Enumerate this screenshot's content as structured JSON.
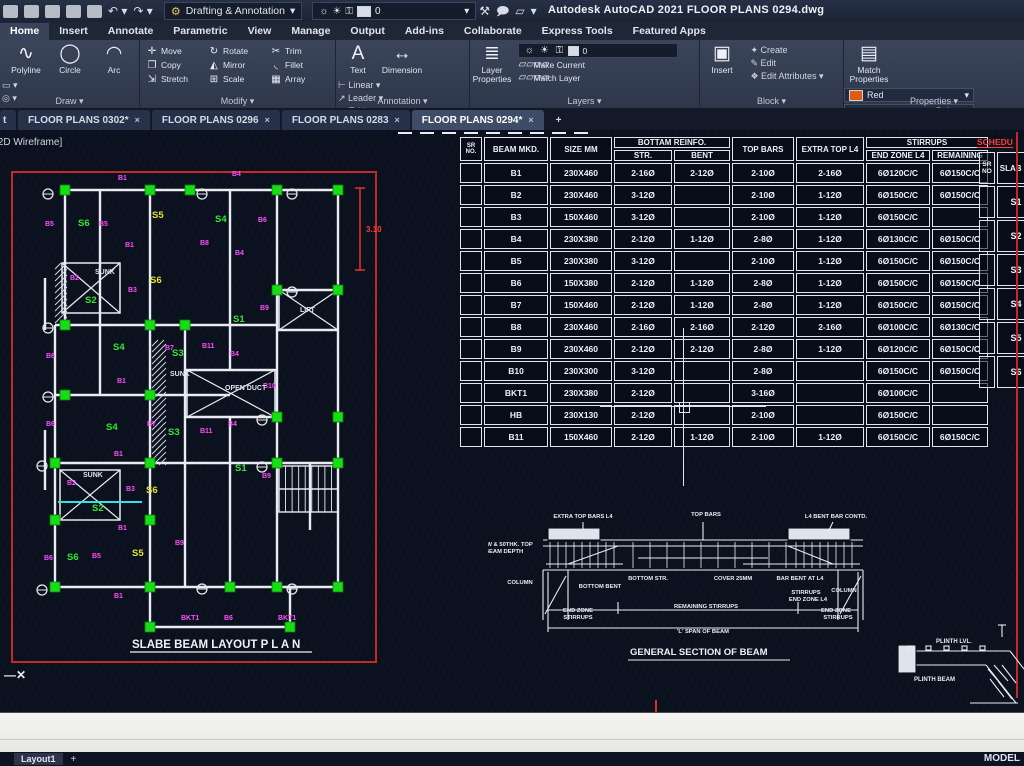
{
  "titlebar": {
    "workspace": "Drafting & Annotation",
    "app_title": "Autodesk AutoCAD 2021   FLOOR PLANS 0294.dwg",
    "layer_value": "0"
  },
  "ribbon": {
    "tabs": [
      {
        "label": "Home",
        "active": true
      },
      {
        "label": "Insert"
      },
      {
        "label": "Annotate"
      },
      {
        "label": "Parametric"
      },
      {
        "label": "View"
      },
      {
        "label": "Manage"
      },
      {
        "label": "Output"
      },
      {
        "label": "Add-ins"
      },
      {
        "label": "Collaborate"
      },
      {
        "label": "Express Tools"
      },
      {
        "label": "Featured Apps"
      }
    ],
    "draw": {
      "title": "Draw",
      "big": [
        "Polyline",
        "Circle",
        "Arc"
      ]
    },
    "modify": {
      "title": "Modify",
      "grid": [
        "Move",
        "Rotate",
        "Trim",
        "Copy",
        "Mirror",
        "Fillet",
        "Stretch",
        "Scale",
        "Array"
      ]
    },
    "annotation": {
      "title": "Annotation",
      "big": [
        "Text",
        "Dimension"
      ],
      "small": [
        "Linear",
        "Leader",
        "Table"
      ]
    },
    "layers": {
      "title": "Layers",
      "big": "Layer\nProperties",
      "layer_value": "0",
      "small": [
        "Make Current",
        "Match Layer"
      ]
    },
    "block": {
      "title": "Block",
      "big": "Insert",
      "small": [
        "Create",
        "Edit",
        "Edit Attributes"
      ]
    },
    "properties": {
      "title": "Properties",
      "big": "Match\nProperties",
      "color": "Red",
      "linetype": "ByLayer",
      "lineweight": "ByLayer"
    }
  },
  "file_tabs": {
    "partial": "t",
    "tabs": [
      {
        "label": "FLOOR PLANS 0302*",
        "active": false
      },
      {
        "label": "FLOOR PLANS 0296",
        "active": false
      },
      {
        "label": "FLOOR PLANS 0283",
        "active": false
      },
      {
        "label": "FLOOR PLANS 0294*",
        "active": true
      }
    ],
    "new_tab": "+"
  },
  "viewport_label": "[2D Wireframe]",
  "plan": {
    "title": "SLABE BEAM LAYOUT  P L A N",
    "dim_label": "3.10",
    "labels": [
      [
        "B1",
        118,
        50,
        "m"
      ],
      [
        "B1",
        125,
        117,
        "m"
      ],
      [
        "B1",
        117,
        253,
        "m"
      ],
      [
        "B1",
        114,
        326,
        "m"
      ],
      [
        "B1",
        118,
        400,
        "m"
      ],
      [
        "B1",
        114,
        468,
        "m"
      ],
      [
        "B2",
        70,
        150,
        "m"
      ],
      [
        "B2",
        67,
        355,
        "m"
      ],
      [
        "B3",
        128,
        162,
        "m"
      ],
      [
        "B3",
        126,
        361,
        "m"
      ],
      [
        "B4",
        232,
        46,
        "m"
      ],
      [
        "B4",
        235,
        125,
        "m"
      ],
      [
        "B4",
        230,
        226,
        "m"
      ],
      [
        "B4",
        228,
        296,
        "m"
      ],
      [
        "B5",
        45,
        96,
        "m"
      ],
      [
        "B5",
        99,
        96,
        "m"
      ],
      [
        "B5",
        92,
        428,
        "m"
      ],
      [
        "B6",
        258,
        92,
        "m"
      ],
      [
        "B6",
        46,
        228,
        "m"
      ],
      [
        "B6",
        46,
        296,
        "m"
      ],
      [
        "B6",
        44,
        430,
        "m"
      ],
      [
        "B6",
        224,
        490,
        "m"
      ],
      [
        "B7",
        165,
        220,
        "m"
      ],
      [
        "B7",
        147,
        296,
        "m"
      ],
      [
        "B8",
        200,
        115,
        "m"
      ],
      [
        "B9",
        260,
        180,
        "m"
      ],
      [
        "B9",
        262,
        348,
        "m"
      ],
      [
        "B9",
        175,
        415,
        "m"
      ],
      [
        "B10",
        263,
        258,
        "m"
      ],
      [
        "B11",
        202,
        218,
        "m"
      ],
      [
        "B11",
        200,
        303,
        "m"
      ],
      [
        "BKT1",
        181,
        490,
        "m"
      ],
      [
        "BKT1",
        278,
        490,
        "m"
      ],
      [
        "S1",
        233,
        192,
        "g"
      ],
      [
        "S1",
        235,
        341,
        "g"
      ],
      [
        "S2",
        85,
        173,
        "g"
      ],
      [
        "S2",
        92,
        381,
        "g"
      ],
      [
        "S3",
        172,
        226,
        "g"
      ],
      [
        "S3",
        168,
        305,
        "g"
      ],
      [
        "S4",
        215,
        92,
        "g"
      ],
      [
        "S4",
        113,
        220,
        "g"
      ],
      [
        "S4",
        106,
        300,
        "g"
      ],
      [
        "S5",
        152,
        88,
        "y"
      ],
      [
        "S5",
        132,
        426,
        "y"
      ],
      [
        "S6",
        78,
        96,
        "g"
      ],
      [
        "S6",
        67,
        430,
        "g"
      ],
      [
        "S6",
        150,
        153,
        "y"
      ],
      [
        "S6",
        146,
        363,
        "y"
      ],
      [
        "SUNK",
        95,
        144,
        "w"
      ],
      [
        "SUNK",
        170,
        246,
        "w"
      ],
      [
        "SUNK",
        83,
        347,
        "w"
      ],
      [
        "LIFT",
        300,
        182,
        "w"
      ],
      [
        "OPEN DUCT",
        225,
        260,
        "w"
      ]
    ],
    "geo": {
      "red_rect": [
        12,
        42,
        364,
        490
      ],
      "lines": [
        [
          65,
          60,
          338,
          60
        ],
        [
          55,
          195,
          277,
          195
        ],
        [
          277,
          160,
          338,
          160
        ],
        [
          277,
          200,
          338,
          200
        ],
        [
          55,
          265,
          230,
          265
        ],
        [
          55,
          333,
          338,
          333
        ],
        [
          185,
          240,
          277,
          240
        ],
        [
          185,
          287,
          277,
          287
        ],
        [
          55,
          457,
          338,
          457
        ],
        [
          150,
          497,
          290,
          497
        ],
        [
          65,
          60,
          65,
          195
        ],
        [
          55,
          195,
          55,
          457
        ],
        [
          100,
          60,
          100,
          265
        ],
        [
          150,
          60,
          150,
          497
        ],
        [
          185,
          195,
          185,
          457
        ],
        [
          230,
          60,
          230,
          240
        ],
        [
          230,
          287,
          230,
          457
        ],
        [
          277,
          60,
          277,
          457
        ],
        [
          338,
          60,
          338,
          457
        ],
        [
          310,
          333,
          310,
          400
        ],
        [
          290,
          457,
          290,
          497
        ],
        [
          45,
          148,
          45,
          200
        ],
        [
          45,
          300,
          45,
          360
        ]
      ],
      "xboxes": [
        [
          62,
          133,
          58,
          50
        ],
        [
          279,
          160,
          59,
          40
        ],
        [
          187,
          240,
          88,
          47
        ],
        [
          60,
          340,
          60,
          50
        ]
      ],
      "hatch": [
        [
          55,
          133,
          12,
          62
        ],
        [
          152,
          210,
          14,
          125
        ]
      ],
      "stairs": [
        279,
        336,
        59,
        46
      ],
      "cyan": [
        58,
        372,
        142,
        372
      ],
      "dim": [
        360,
        58,
        140,
        366,
        102
      ],
      "grips": [
        [
          65,
          60
        ],
        [
          150,
          60
        ],
        [
          190,
          60
        ],
        [
          277,
          60
        ],
        [
          338,
          60
        ],
        [
          277,
          160
        ],
        [
          338,
          160
        ],
        [
          65,
          195
        ],
        [
          150,
          195
        ],
        [
          185,
          195
        ],
        [
          65,
          265
        ],
        [
          150,
          265
        ],
        [
          277,
          287
        ],
        [
          338,
          287
        ],
        [
          55,
          333
        ],
        [
          150,
          333
        ],
        [
          277,
          333
        ],
        [
          338,
          333
        ],
        [
          55,
          390
        ],
        [
          150,
          390
        ],
        [
          55,
          457
        ],
        [
          150,
          457
        ],
        [
          230,
          457
        ],
        [
          277,
          457
        ],
        [
          338,
          457
        ],
        [
          150,
          497
        ],
        [
          290,
          497
        ]
      ],
      "circles": [
        [
          48,
          64
        ],
        [
          48,
          198
        ],
        [
          42,
          336
        ],
        [
          42,
          460
        ],
        [
          202,
          64
        ],
        [
          292,
          64
        ],
        [
          262,
          290
        ],
        [
          262,
          337
        ],
        [
          292,
          162
        ],
        [
          202,
          459
        ],
        [
          292,
          459
        ],
        [
          48,
          267
        ]
      ]
    }
  },
  "beam_schedule": {
    "headers": {
      "sr": "SR NO.",
      "mkd": "BEAM MKD.",
      "size": "SIZE MM",
      "bottom": "BOTTAM REINFO.",
      "str": "STR.",
      "bent": "BENT",
      "top": "TOP BARS",
      "extra": "EXTRA TOP L4",
      "stirrups": "STIRRUPS",
      "endzone": "END ZONE L4",
      "remaining": "REMAINING"
    },
    "rows": [
      [
        "B1",
        "230X460",
        "2-16Ø",
        "2-12Ø",
        "2-10Ø",
        "2-16Ø",
        "6Ø120C/C",
        "6Ø150C/C"
      ],
      [
        "B2",
        "230X460",
        "3-12Ø",
        "",
        "2-10Ø",
        "1-12Ø",
        "6Ø150C/C",
        "6Ø150C/C"
      ],
      [
        "B3",
        "150X460",
        "3-12Ø",
        "",
        "2-10Ø",
        "1-12Ø",
        "6Ø150C/C",
        ""
      ],
      [
        "B4",
        "230X380",
        "2-12Ø",
        "1-12Ø",
        "2-8Ø",
        "1-12Ø",
        "6Ø130C/C",
        "6Ø150C/C"
      ],
      [
        "B5",
        "230X380",
        "3-12Ø",
        "",
        "2-10Ø",
        "1-12Ø",
        "6Ø150C/C",
        "6Ø150C/C"
      ],
      [
        "B6",
        "150X380",
        "2-12Ø",
        "1-12Ø",
        "2-8Ø",
        "1-12Ø",
        "6Ø150C/C",
        "6Ø150C/C"
      ],
      [
        "B7",
        "150X460",
        "2-12Ø",
        "1-12Ø",
        "2-8Ø",
        "1-12Ø",
        "6Ø150C/C",
        "6Ø150C/C"
      ],
      [
        "B8",
        "230X460",
        "2-16Ø",
        "2-16Ø",
        "2-12Ø",
        "2-16Ø",
        "6Ø100C/C",
        "6Ø130C/C"
      ],
      [
        "B9",
        "230X460",
        "2-12Ø",
        "2-12Ø",
        "2-8Ø",
        "1-12Ø",
        "6Ø120C/C",
        "6Ø150C/C"
      ],
      [
        "B10",
        "230X300",
        "3-12Ø",
        "",
        "2-8Ø",
        "",
        "6Ø150C/C",
        "6Ø150C/C"
      ],
      [
        "BKT1",
        "230X380",
        "2-12Ø",
        "",
        "3-16Ø",
        "",
        "6Ø100C/C",
        ""
      ],
      [
        "HB",
        "230X130",
        "2-12Ø",
        "",
        "2-10Ø",
        "",
        "6Ø150C/C",
        ""
      ],
      [
        "B11",
        "150X460",
        "2-12Ø",
        "1-12Ø",
        "2-10Ø",
        "1-12Ø",
        "6Ø150C/C",
        "6Ø150C/C"
      ]
    ]
  },
  "slab_schedule": {
    "title": "SCHEDU",
    "h1": "SR NO",
    "h2": "SLAB",
    "rows": [
      "S1",
      "S2",
      "S3",
      "S4",
      "S5",
      "S6"
    ]
  },
  "section": {
    "title": "GENERAL SECTION OF BEAM",
    "labels": [
      [
        "EXTRA TOP BARS L4",
        95,
        16
      ],
      [
        "TOP BARS",
        218,
        14
      ],
      [
        "L4 BENT BAR CONTD.",
        348,
        16
      ],
      [
        "7W & 50THK. TOP",
        20,
        44
      ],
      [
        "BEAM DEPTH",
        16,
        51
      ],
      [
        "COLUMN",
        32,
        82
      ],
      [
        "BOTTOM BENT",
        112,
        86
      ],
      [
        "BOTTOM STR.",
        160,
        78
      ],
      [
        "COVER 25MM",
        245,
        78
      ],
      [
        "BAR BENT AT L4",
        312,
        78
      ],
      [
        "STIRRUPS",
        318,
        92
      ],
      [
        "END ZONE L4",
        320,
        99
      ],
      [
        "REMAINING STIRRUPS",
        218,
        106
      ],
      [
        "END ZONE",
        90,
        110
      ],
      [
        "STIRRUPS",
        90,
        117
      ],
      [
        "COLUMN",
        356,
        90
      ],
      [
        "END ZONE",
        348,
        110
      ],
      [
        "STIRRUPS",
        350,
        117
      ],
      [
        "'L' SPAN OF BEAM",
        215,
        131
      ]
    ]
  },
  "plinth": {
    "labels": [
      [
        "PLINTH LVL.",
        46,
        30
      ],
      [
        "PLINTH BEAM",
        24,
        68
      ]
    ]
  },
  "statusbar": {
    "layout": "Layout1",
    "plus": "+",
    "mode": "MODEL"
  }
}
